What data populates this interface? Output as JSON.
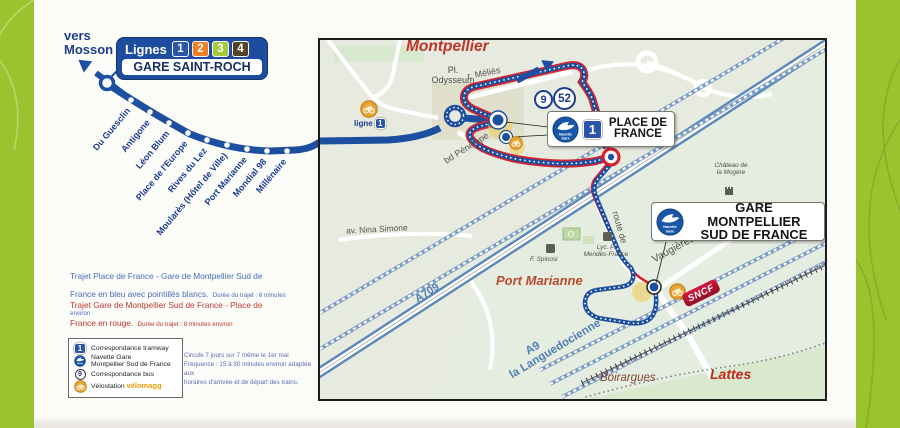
{
  "header": {
    "direction_line1": "vers",
    "direction_line2": "Mosson",
    "lignes_label": "Lignes",
    "line_numbers": [
      {
        "num": "1",
        "color": "#2b55a8"
      },
      {
        "num": "2",
        "color": "#ee7f24"
      },
      {
        "num": "3",
        "color": "#a7c93d"
      },
      {
        "num": "4",
        "color": "#544427"
      }
    ],
    "terminus": "GARE SAINT-ROCH"
  },
  "tram_stops": [
    "Du Guesclin",
    "Antigone",
    "Léon Blum",
    "Place de l'Europe",
    "Rives du Lez",
    "Moularès (Hôtel de Ville)",
    "Port Marianne",
    "Mondial 98",
    "Millénaire"
  ],
  "map": {
    "city": "Montpellier",
    "pl_odysseum_line1": "Pl.",
    "pl_odysseum_line2": "Odysseum",
    "r_melies": "r. Méliès",
    "bd_penelope": "bd Pénélope",
    "av_nina_simone": "av. Nina Simone",
    "route_de": "route de",
    "vaugieres": "Vaugières",
    "ligne1_label": "ligne",
    "ligne1_num": "1",
    "bus_line_1": "9",
    "bus_line_2": "52",
    "place_de_france": {
      "line1": "PLACE DE",
      "line2": "FRANCE",
      "tram_num": "1"
    },
    "gare_sud": {
      "line1": "GARE MONTPELLIER",
      "line2": "SUD DE FRANCE"
    },
    "navette_icon": {
      "line1": "Navette",
      "line2": "Gare"
    },
    "chateau_line1": "Château de",
    "chateau_line2": "la Mogère",
    "port_marianne": "Port Marianne",
    "boirargues": "Boirargues",
    "lattes": "Lattes",
    "a709": "A709",
    "a9": "A9",
    "languedocienne": "la Languedocienne",
    "spinosi": "F. Spinosi",
    "lycee_line1": "Lyc. P.",
    "lycee_line2": "Mendès-France",
    "sncf": "SNCF"
  },
  "legend": {
    "blue_route_text": "Trajet Place de France - Gare de Montpellier Sud de France en bleu avec pointillés blancs.",
    "blue_route_note": "Durée du trajet : 6 minutes environ",
    "red_route_text": "Trajet Gare de Montpellier Sud de France - Place de France en rouge.",
    "red_route_note": "Durée du trajet : 8 minutes environ",
    "item1_badge": "1",
    "item1": "Correspondance tramway",
    "item2_line1": "Navette Gare",
    "item2_line2": "Montpellier Sud de France",
    "item3_badge": "9",
    "item3": "Correspondance bus",
    "item4_label": "Vélostation",
    "item4_brand": "vélomagg",
    "freq_line1": "Circule 7 jours sur 7 même le 1er mai",
    "freq_line2": "Fréquence : 15 à 30 minutes environ adaptée aux",
    "freq_line3": "horaires d'arrivée et de départ des trains."
  },
  "colors": {
    "green_frame": "#9ac42d",
    "tram_blue": "#1d4fa1",
    "route_red": "#d2232e",
    "navy_text": "#1d3e8f",
    "railway_blue": "#7c9cc3",
    "highway_blue": "#5c88ba",
    "velomagg_orange": "#ecab3d"
  }
}
